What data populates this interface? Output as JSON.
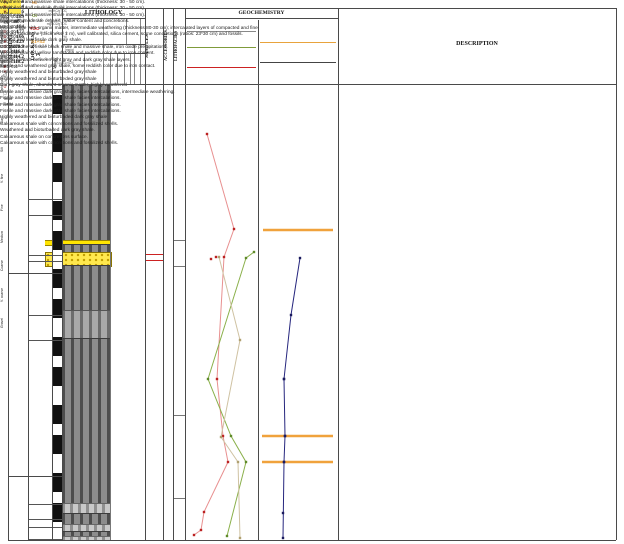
{
  "header": {
    "columns": {
      "segment": "SEGMENT",
      "thickness": "THICKNESS",
      "meters": "Meters",
      "lithology": "LITHOLOGY",
      "samples": "SAMPLES",
      "accessories": "ACCESSORIES",
      "lithofacies": "LITHOFACIES",
      "geochemistry": "GEOCHEMISTRY",
      "description": "DESCRIPTION"
    },
    "lithology_groups": [
      {
        "label": "Mudstone",
        "cx": 82
      },
      {
        "label": "Psammites",
        "cx": 114
      },
      {
        "label": "Psephites",
        "cx": 133
      },
      {
        "label": "Carbonates",
        "cx": 142
      }
    ],
    "grain_rows": [
      {
        "label": "Mud",
        "cx": 82
      },
      {
        "label": "Sand",
        "cx": 118
      }
    ],
    "grain_sizes": [
      {
        "label": "Clay",
        "cx": 72
      },
      {
        "label": "Silt",
        "cx": 92
      },
      {
        "label": "V. fine",
        "cx": 106
      },
      {
        "label": "Fine",
        "cx": 113
      },
      {
        "label": "Medium",
        "cx": 120
      },
      {
        "label": "Coarse",
        "cx": 127
      },
      {
        "label": "V. coarse",
        "cx": 132
      },
      {
        "label": "Gravel",
        "cx": 142
      }
    ]
  },
  "geochem_scales": {
    "left": [
      {
        "label": "HI",
        "color": "#d8862c",
        "ticks": "0 1 2 3 4 5 6 7 8 9 10",
        "unit": "mgHC/gTOC",
        "rule_color": "#888888"
      },
      {
        "label": "OI",
        "color": "#7f9b3a",
        "ticks": "0 2 4 6 8 10 12 14 16 18 20",
        "unit": "mgCO2/gTOC",
        "rule_color": "#7f9b3a"
      },
      {
        "label": "TOC",
        "color": "#cc2222",
        "ticks": "0.5 1 2 3 4 5 6 7 8 9 10",
        "unit": "(%)",
        "rule_color": "#cc2222"
      }
    ],
    "right": [
      {
        "label": "S1+S2",
        "color": "#e8a33d",
        "ticks": "0.2 0.4 0.6 0.8 1.0 1.2",
        "unit": "(mg/g)",
        "rule_color": "#e8a33d"
      },
      {
        "label": "PI",
        "color": "#333333",
        "ticks": "0.1 0.2 0.3 0.4 0.5",
        "unit": "(S1/(S1+S2))",
        "rule_color": "#444444"
      }
    ]
  },
  "depths": [
    {
      "label": "237.4",
      "y": 86
    },
    {
      "label": "205.4",
      "y": 196
    },
    {
      "label": "200.6",
      "y": 212
    },
    {
      "label": "189",
      "y": 252
    },
    {
      "label": "187.4",
      "y": 258
    },
    {
      "label": "184",
      "y": 270
    },
    {
      "label": "177",
      "y": 312
    },
    {
      "label": "166",
      "y": 337
    },
    {
      "label": "129",
      "y": 473
    },
    {
      "label": "120.9",
      "y": 501
    },
    {
      "label": "116.8",
      "y": 516
    },
    {
      "label": "114.2",
      "y": 524
    },
    {
      "label": "110.2",
      "y": 536
    }
  ],
  "segments": {
    "labels": [
      {
        "label": "6",
        "y": 176
      },
      {
        "label": "5",
        "y": 375
      },
      {
        "label": "4",
        "y": 508
      }
    ],
    "boundaries": [
      273,
      476
    ]
  },
  "lithology_beds": [
    {
      "y0": 84,
      "y1": 240,
      "type": "dark"
    },
    {
      "y0": 240,
      "y1": 244,
      "type": "yellow"
    },
    {
      "y0": 244,
      "y1": 252,
      "type": "dark"
    },
    {
      "y0": 252,
      "y1": 265,
      "type": "sand"
    },
    {
      "y0": 265,
      "y1": 310,
      "type": "dark"
    },
    {
      "y0": 310,
      "y1": 338,
      "type": "medium"
    },
    {
      "y0": 338,
      "y1": 503,
      "type": "dark"
    },
    {
      "y0": 503,
      "y1": 513,
      "type": "light"
    },
    {
      "y0": 513,
      "y1": 524,
      "type": "dark"
    },
    {
      "y0": 524,
      "y1": 531,
      "type": "light"
    },
    {
      "y0": 531,
      "y1": 536,
      "type": "dark"
    },
    {
      "y0": 536,
      "y1": 540,
      "type": "light"
    }
  ],
  "samples": [
    {
      "label": "MEG-001",
      "y": 128,
      "highlight": false
    },
    {
      "label": "MEG-002",
      "y": 200,
      "highlight": false
    },
    {
      "label": "MEG-003",
      "y": 226,
      "highlight": false
    },
    {
      "label": "MEG-004",
      "y": 251,
      "highlight": true
    },
    {
      "label": "MEG-005",
      "y": 257,
      "highlight": true
    },
    {
      "label": "MEG-006",
      "y": 383,
      "highlight": false
    },
    {
      "label": "MEG-007",
      "y": 437,
      "highlight": false
    },
    {
      "label": "MEG-008",
      "y": 458,
      "highlight": false
    },
    {
      "label": "MEG-009",
      "y": 513,
      "highlight": false
    },
    {
      "label": "MEG-010",
      "y": 529,
      "highlight": false
    },
    {
      "label": "MEG-011",
      "y": 535,
      "highlight": false
    }
  ],
  "accessories": [
    {
      "type": "star",
      "y": 100
    },
    {
      "type": "star",
      "y": 133
    },
    {
      "type": "star",
      "y": 170
    },
    {
      "type": "concretion",
      "y": 202
    },
    {
      "type": "text",
      "label": "HM",
      "y": 227
    },
    {
      "type": "concretion",
      "y": 246
    },
    {
      "type": "shell",
      "y": 258
    },
    {
      "type": "shell",
      "y": 265
    },
    {
      "type": "star",
      "y": 272
    },
    {
      "type": "shell",
      "y": 281
    },
    {
      "type": "shell",
      "y": 290
    },
    {
      "type": "trident",
      "y": 307
    },
    {
      "type": "text",
      "label": "W/Fbu",
      "y": 352
    },
    {
      "type": "star",
      "y": 382
    },
    {
      "type": "star",
      "y": 405
    },
    {
      "type": "trident",
      "y": 490
    },
    {
      "type": "concretion",
      "y": 513
    },
    {
      "type": "shell",
      "y": 526
    },
    {
      "type": "concretion",
      "y": 535
    }
  ],
  "lithofacies": {
    "zones": [
      {
        "label": "Fs",
        "y": 158
      },
      {
        "label": "Fw/Sla",
        "y": 252
      },
      {
        "label": "Fs",
        "y": 330
      },
      {
        "label": "Ws",
        "y": 437
      },
      {
        "label": "Cs",
        "y": 522
      }
    ],
    "boundaries": [
      240,
      266,
      415,
      498
    ]
  },
  "descriptions": [
    {
      "y": 86,
      "text": "Weathered and massive shale intercalations (thickness: 30 - 50 cm)."
    },
    {
      "y": 122,
      "text": "Weathered and massive shale intercalations (thickness: 30 - 50 cm)."
    },
    {
      "y": 158,
      "text": "Weathered and massive shale intercalations (thickness: 30 - 50 cm)."
    },
    {
      "y": 190,
      "text": "Shale with moderate organic matter content and concretions."
    },
    {
      "y": 207,
      "text": "Fissile shale with organic matter, intermediate weathering (thickness 80-30 cm); intercalated layers of compacted and fine grained sandstone (thickness: 1 m), well calibrated, silica cement, some concretions (ratios: 23*30 cm) and fossils."
    },
    {
      "y": 242,
      "text": "Jointed and low fissile dark gray shale."
    },
    {
      "y": 249,
      "text": "Contact zone of fissile black shale and massive shale, iron oxide precipitations."
    },
    {
      "y": 256,
      "text": "Very fine grained yellow sandstone and reddish color due to iron content."
    },
    {
      "y": 262,
      "text": "Diffuse contact between light gray and dark gray shale layers."
    },
    {
      "y": 280,
      "text": "Fissile and weathered gray shale, some reddish color due to iron contact."
    },
    {
      "y": 301,
      "text": "Highly weathered and bioturbaded gray shale"
    },
    {
      "y": 324,
      "text": "Highly weathered and bioturbeded gray shale"
    },
    {
      "y": 345,
      "text": "Dark gray shale, abundant organic matter, highly weathered"
    },
    {
      "y": 365,
      "text": "Fissile and massive dark gray shale facies intercalations, intermediate weathering."
    },
    {
      "y": 393,
      "text": "Fissile and massive dark gray shale facies intercalations."
    },
    {
      "y": 422,
      "text": "Fissile and massive dark gray shale facies intercalations."
    },
    {
      "y": 447,
      "text": "Fissile and massive dark gray shale facies intercalations."
    },
    {
      "y": 478,
      "text": "Highly weathered and bioturbaded dark gray shale"
    },
    {
      "y": 500,
      "text": "Calcareous shale with concretions and fossilized shells."
    },
    {
      "y": 512,
      "text": "Weathered and bioturbaded dark gray shale."
    },
    {
      "y": 521,
      "text": "Calcareous shale on concretions surface."
    },
    {
      "y": 533,
      "text": "Calcareous shale with concretions and fossilized shells."
    }
  ],
  "plot_px": {
    "series": [
      {
        "name": "toc-curve",
        "color": "#e89090",
        "marker_color": "#bb2222",
        "points": [
          [
            207,
            134
          ],
          [
            234,
            229
          ],
          [
            224,
            257
          ],
          [
            217,
            379
          ],
          [
            223,
            436
          ],
          [
            228,
            462
          ],
          [
            204,
            512
          ],
          [
            201,
            530
          ],
          [
            194,
            535
          ]
        ],
        "extra_markers": [
          [
            211,
            259
          ],
          [
            216,
            257
          ]
        ]
      },
      {
        "name": "oi-curve",
        "color": "#8ab04a",
        "marker_color": "#5f8a2a",
        "points": [
          [
            254,
            252
          ],
          [
            246,
            258
          ],
          [
            208,
            379
          ],
          [
            231,
            436
          ],
          [
            246,
            462
          ],
          [
            227,
            536
          ]
        ],
        "extra_markers": []
      },
      {
        "name": "hi-curve",
        "color": "#cfc2a2",
        "marker_color": "#b0a070",
        "points": [
          [
            219,
            257
          ],
          [
            240,
            340
          ],
          [
            221,
            437
          ],
          [
            238,
            462
          ],
          [
            240,
            538
          ]
        ],
        "extra_markers": []
      },
      {
        "name": "pi-curve",
        "color": "#26267e",
        "marker_color": "#1a1a5e",
        "points": [
          [
            300,
            258
          ],
          [
            291,
            315
          ],
          [
            284,
            379
          ],
          [
            285,
            436
          ],
          [
            284,
            462
          ],
          [
            283,
            538
          ]
        ],
        "extra_markers": [
          [
            284,
            379
          ],
          [
            285,
            436
          ],
          [
            284,
            462
          ],
          [
            283,
            513
          ]
        ]
      }
    ],
    "orange_bars": [
      [
        263,
        230,
        333
      ],
      [
        262,
        436,
        333
      ],
      [
        262,
        462,
        333
      ]
    ],
    "orange_color": "#f0a23c"
  },
  "chart_data": {
    "type": "line",
    "title": "GEOCHEMISTRY",
    "depth_axis": {
      "label": "THICKNESS (m)",
      "top": 237.4,
      "bottom": 110.2
    },
    "panels": [
      {
        "name": "HI / OI / TOC",
        "scales": [
          {
            "name": "HI",
            "unit": "mgHC/gTOC",
            "range": [
              0,
              850
            ]
          },
          {
            "name": "OI",
            "unit": "mgCO2/gTOC",
            "range": [
              0,
              110
            ]
          },
          {
            "name": "TOC",
            "unit": "%",
            "range": [
              0,
              10
            ]
          }
        ],
        "series": [
          {
            "name": "TOC (%)",
            "points_depth_value": [
              [
                223.8,
                2.9
              ],
              [
                197.0,
                6.8
              ],
              [
                189.1,
                5.4
              ],
              [
                154.6,
                4.3
              ],
              [
                138.5,
                5.2
              ],
              [
                131.1,
                5.9
              ],
              [
                117.0,
                2.5
              ],
              [
                111.9,
                2.0
              ],
              [
                110.5,
                1.0
              ]
            ]
          },
          {
            "name": "OI (mgCO2/gTOC)",
            "points_depth_value": [
              [
                190.5,
                107
              ],
              [
                188.8,
                94
              ],
              [
                154.6,
                33
              ],
              [
                138.5,
                70
              ],
              [
                131.1,
                94
              ],
              [
                110.2,
                64
              ]
            ]
          },
          {
            "name": "HI (mgHC/gTOC)",
            "points_depth_value": [
              [
                189.1,
                394
              ],
              [
                165.6,
                653
              ],
              [
                138.2,
                419
              ],
              [
                130.8,
                628
              ],
              [
                109.6,
                665
              ]
            ]
          }
        ]
      },
      {
        "name": "S1+S2 / PI",
        "scales": [
          {
            "name": "S1+S2",
            "unit": "mg/g",
            "range": [
              0,
              1.2
            ]
          },
          {
            "name": "PI",
            "unit": "S1/(S1+S2)",
            "range": [
              0,
              0.5
            ]
          }
        ],
        "series": [
          {
            "name": "PI",
            "points_depth_value": [
              [
                188.8,
                0.26
              ],
              [
                172.7,
                0.2
              ],
              [
                154.6,
                0.16
              ],
              [
                138.5,
                0.16
              ],
              [
                131.1,
                0.16
              ],
              [
                109.6,
                0.15
              ]
            ]
          },
          {
            "name": "S1+S2 horizons (full-width orange bars)",
            "depths": [
              196.7,
              138.5,
              131.1
            ]
          }
        ]
      }
    ],
    "legend_position": "header-rows",
    "grid": false
  }
}
